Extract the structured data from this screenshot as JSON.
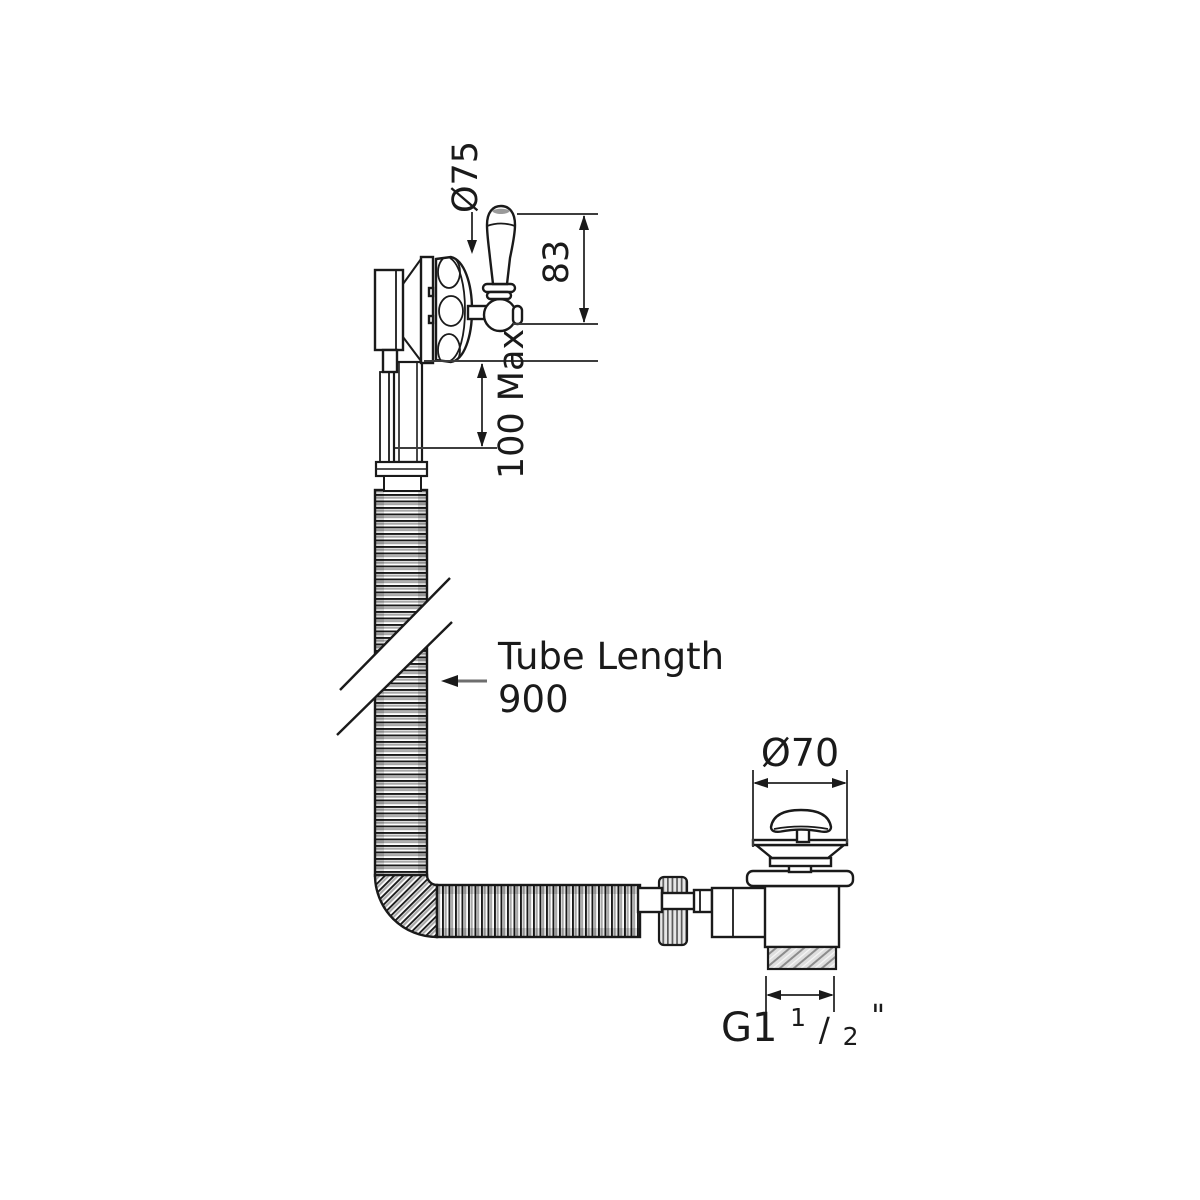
{
  "diagram": {
    "labels": {
      "lever_diameter": "Ø75",
      "lever_height": "83",
      "max_thickness": "100 Max",
      "tube_length_label": "Tube Length",
      "tube_length_value": "900",
      "waste_flange_diameter": "Ø70",
      "thread": {
        "prefix": "G1",
        "numerator": "1",
        "slash": "/",
        "denominator": "2",
        "unit": "\""
      }
    },
    "colors": {
      "line": "#1a1a1a",
      "dimension": "#3d3d3d",
      "shade": "#a8a8a8",
      "background": "#ffffff"
    }
  }
}
